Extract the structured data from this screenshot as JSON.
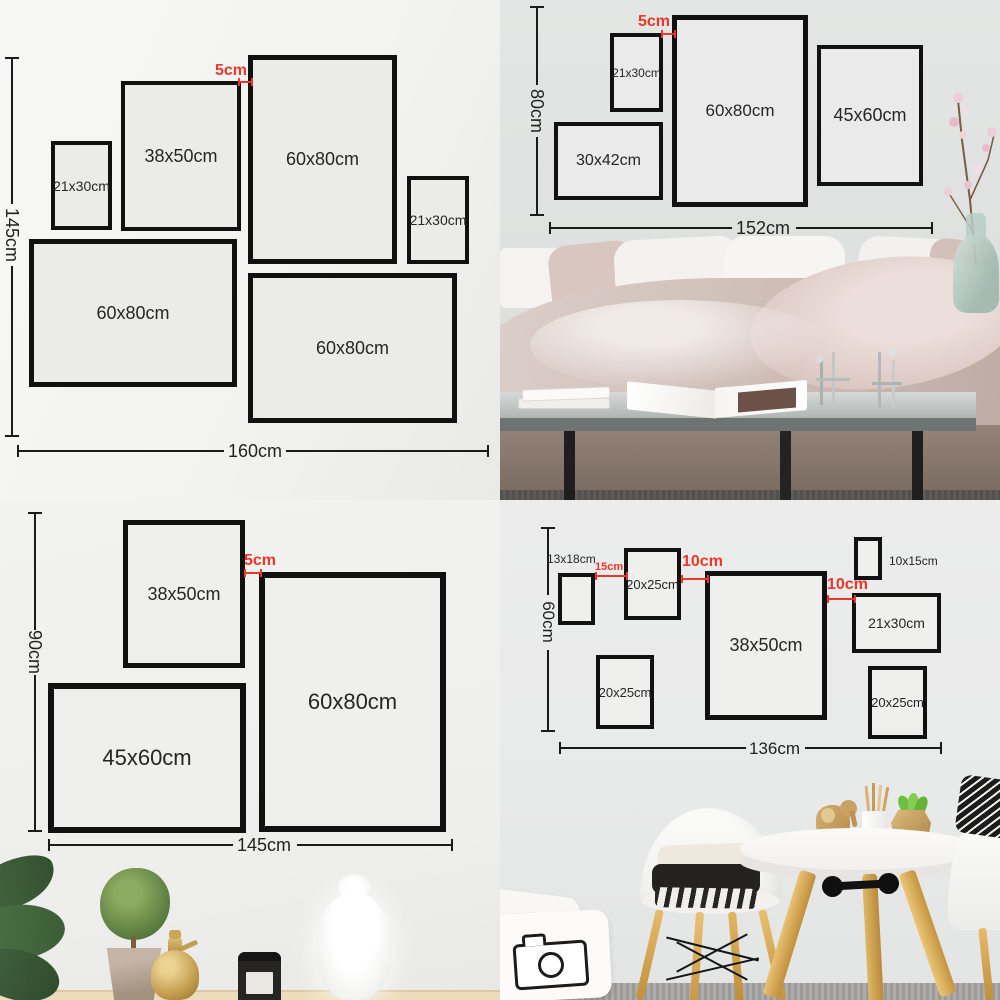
{
  "colors": {
    "annotation_red": "#e8382a",
    "frame_border": "#111111",
    "dimension_line": "#1b1b1b"
  },
  "quadrants": {
    "top_left": {
      "height_label": "145cm",
      "width_label": "160cm",
      "gap_label": "5cm",
      "frames": [
        {
          "size": "21x30cm"
        },
        {
          "size": "38x50cm"
        },
        {
          "size": "60x80cm"
        },
        {
          "size": "21x30cm"
        },
        {
          "size": "60x80cm"
        },
        {
          "size": "60x80cm"
        }
      ]
    },
    "top_right": {
      "height_label": "80cm",
      "width_label": "152cm",
      "gap_label": "5cm",
      "frames": [
        {
          "size": "21x30cm"
        },
        {
          "size": "60x80cm"
        },
        {
          "size": "45x60cm"
        },
        {
          "size": "30x42cm"
        }
      ]
    },
    "bottom_left": {
      "height_label": "90cm",
      "width_label": "145cm",
      "gap_label": "5cm",
      "frames": [
        {
          "size": "38x50cm"
        },
        {
          "size": "60x80cm"
        },
        {
          "size": "45x60cm"
        }
      ]
    },
    "bottom_right": {
      "height_label": "60cm",
      "width_label": "136cm",
      "gap_labels": [
        "15cm",
        "10cm",
        "10cm"
      ],
      "frames": [
        {
          "size": "13x18cm"
        },
        {
          "size": "20x25cm"
        },
        {
          "size": "38x50cm"
        },
        {
          "size": "10x15cm"
        },
        {
          "size": "21x30cm"
        },
        {
          "size": "20x25cm"
        },
        {
          "size": "20x25cm"
        }
      ]
    }
  }
}
